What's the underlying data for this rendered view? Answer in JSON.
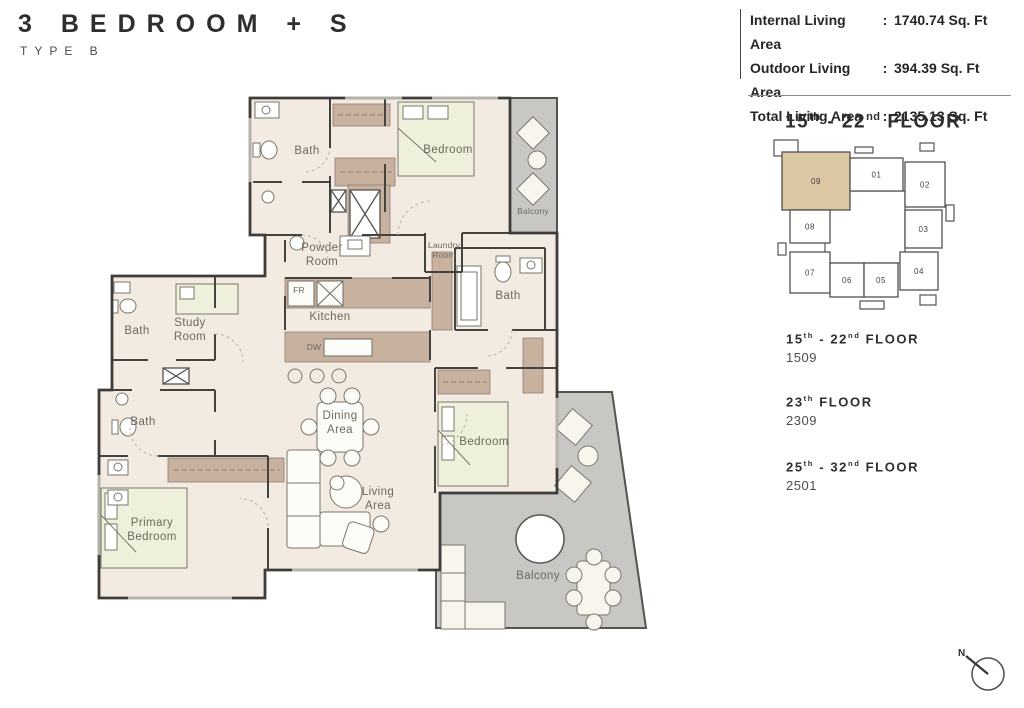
{
  "header": {
    "title": "3  BEDROOM  +  S",
    "subtitle": "TYPE B"
  },
  "stats": {
    "rows": [
      {
        "label": "Internal Living Area",
        "sep": ":",
        "value": "1740.74 Sq. Ft"
      },
      {
        "label": "Outdoor Living Area",
        "sep": ":",
        "value": "394.39 Sq. Ft"
      },
      {
        "label": "Total Living Area",
        "sep": ":",
        "value": "2135.13 Sq. Ft"
      }
    ]
  },
  "keyplan": {
    "title": {
      "p1": "15",
      "s1": "th",
      "p2": " - 22",
      "s2": "nd",
      "p3": " FLOOR"
    },
    "highlight_color": "#dbc7a2",
    "units": [
      {
        "id": "09",
        "x": 12,
        "y": 17,
        "w": 68,
        "h": 58,
        "highlighted": true
      },
      {
        "id": "01",
        "x": 80,
        "y": 23,
        "w": 53,
        "h": 33,
        "highlighted": false
      },
      {
        "id": "02",
        "x": 135,
        "y": 27,
        "w": 40,
        "h": 45,
        "highlighted": false
      },
      {
        "id": "08",
        "x": 20,
        "y": 75,
        "w": 40,
        "h": 33,
        "highlighted": false
      },
      {
        "id": "03",
        "x": 135,
        "y": 75,
        "w": 37,
        "h": 38,
        "highlighted": false
      },
      {
        "id": "07",
        "x": 20,
        "y": 117,
        "w": 40,
        "h": 41,
        "highlighted": false
      },
      {
        "id": "06",
        "x": 60,
        "y": 128,
        "w": 34,
        "h": 34,
        "highlighted": false
      },
      {
        "id": "05",
        "x": 94,
        "y": 128,
        "w": 34,
        "h": 34,
        "highlighted": false
      },
      {
        "id": "04",
        "x": 130,
        "y": 117,
        "w": 38,
        "h": 38,
        "highlighted": false
      }
    ]
  },
  "floors": [
    {
      "p1": "15",
      "s1": "th",
      "p2": " - 22",
      "s2": "nd",
      "p3": " FLOOR",
      "unit": "1509"
    },
    {
      "p1": "23",
      "s1": "th",
      "p2": "",
      "s2": "",
      "p3": " FLOOR",
      "unit": "2309"
    },
    {
      "p1": "25",
      "s1": "th",
      "p2": " - 32",
      "s2": "nd",
      "p3": " FLOOR",
      "unit": "2501"
    }
  ],
  "plan": {
    "labels": [
      {
        "text": "Bath",
        "x": 307,
        "y": 152
      },
      {
        "text": "Bedroom",
        "x": 448,
        "y": 151
      },
      {
        "text": "Balcony",
        "x": 533,
        "y": 211,
        "small": true
      },
      {
        "text": "Powder\nRoom",
        "x": 322,
        "y": 256
      },
      {
        "text": "Laundry\nRoom",
        "x": 444,
        "y": 250,
        "small": true
      },
      {
        "text": "FR",
        "x": 299,
        "y": 290,
        "small": true
      },
      {
        "text": "Kitchen",
        "x": 330,
        "y": 318
      },
      {
        "text": "DW",
        "x": 314,
        "y": 347,
        "small": true
      },
      {
        "text": "Bath",
        "x": 137,
        "y": 332
      },
      {
        "text": "Study\nRoom",
        "x": 190,
        "y": 331
      },
      {
        "text": "Bath",
        "x": 143,
        "y": 423
      },
      {
        "text": "Dining\nArea",
        "x": 340,
        "y": 424
      },
      {
        "text": "Bath",
        "x": 508,
        "y": 297
      },
      {
        "text": "Bedroom",
        "x": 484,
        "y": 443
      },
      {
        "text": "Living\nArea",
        "x": 378,
        "y": 500
      },
      {
        "text": "Primary\nBedroom",
        "x": 152,
        "y": 531
      },
      {
        "text": "Balcony",
        "x": 538,
        "y": 577
      }
    ]
  },
  "compass": {
    "label": "N"
  }
}
